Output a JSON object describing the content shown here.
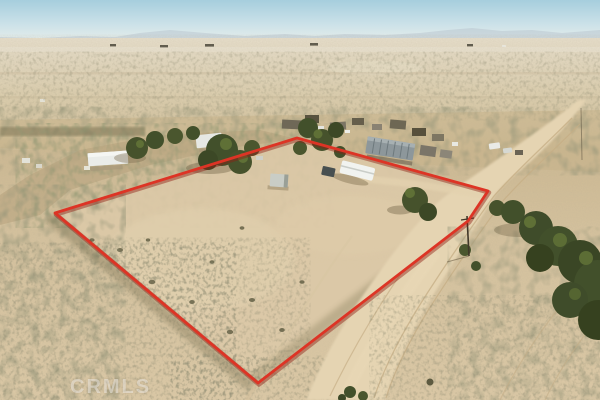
{
  "watermark": {
    "text": "CRMLS"
  },
  "colors": {
    "sky_top": "#a6cedd",
    "sky_horizon": "#eef1ea",
    "mountain_haze": "#b7c4cd",
    "plain_sand": "#dbcdad",
    "foreground_sand": "#d5c29e",
    "parcel_sand": "#dccaa8",
    "road_sand": "#e5d4b2",
    "scrub_dark": "#6b6547",
    "tree_green": "#42502b",
    "tree_green_light": "#5f7036",
    "boundary_red": "#dd3425",
    "boundary_red_dark": "#8f1d12",
    "roof_white": "#eaece9",
    "mobile_home_gray": "#8d979b",
    "rv_white": "#f1f3f0",
    "pole_brown": "#403729"
  }
}
